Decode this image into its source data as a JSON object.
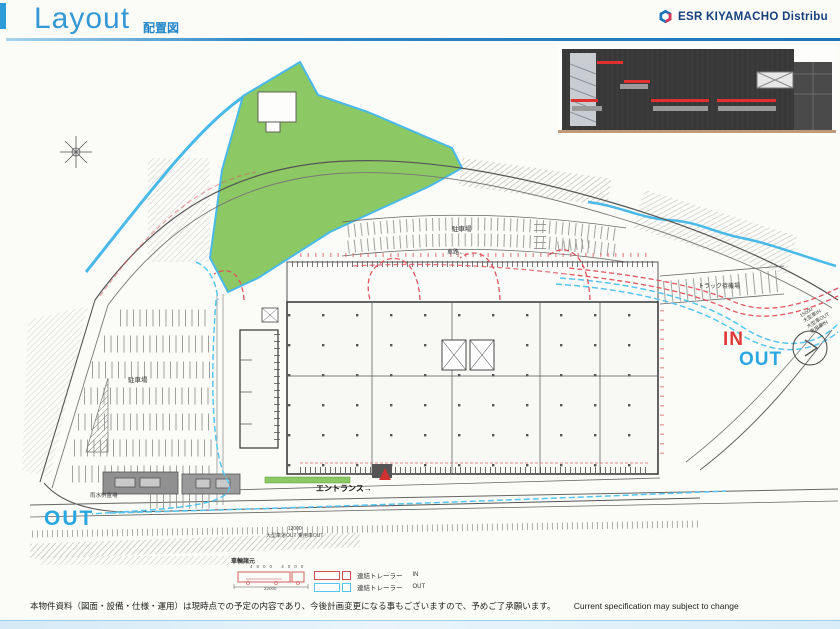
{
  "header": {
    "title": "Layout",
    "subtitle": "配置図",
    "brand": "ESR KIYAMACHO Distribu"
  },
  "plan": {
    "labels": {
      "parking_left": "駐車場",
      "parking_top": "駐車場",
      "lane": "車路←",
      "truck_waiting": "トラック待機場",
      "in_label": "IN",
      "out_right": "OUT",
      "out_bottom": "OUT",
      "entrance": "エントランス→",
      "rainwater": "雨水桝置場",
      "right_dim_1": "15000",
      "right_dim_2": "大型車IN",
      "right_dim_3": "大型車OUT",
      "right_dim_4": "乗用車IN",
      "bottom_dim_1": "12000",
      "bottom_dim_2": "大型車道OUT",
      "bottom_dim_3": "乗用車OUT"
    }
  },
  "legend": {
    "title": "車輌諸元",
    "top_dims": "4500  4000",
    "bottom_dim": "22000",
    "items": [
      {
        "label": "連結トレーラー",
        "dir": "IN"
      },
      {
        "label": "連結トレーラー",
        "dir": "OUT"
      }
    ]
  },
  "footer": {
    "note_jp": "本物件資料（図面・設備・仕様・運用）は現時点での予定の内容であり、今後計画変更になる事もございますので、予めご了承願います。",
    "note_en": "Current specification may subject to change"
  },
  "colors": {
    "accent_blue": "#2f9ad8",
    "brand_navy": "#16407c",
    "route_in_red": "#e0555e",
    "route_out_blue": "#56c6ee",
    "green_area": "#8cc863",
    "stream_blue": "#49b9e9"
  }
}
